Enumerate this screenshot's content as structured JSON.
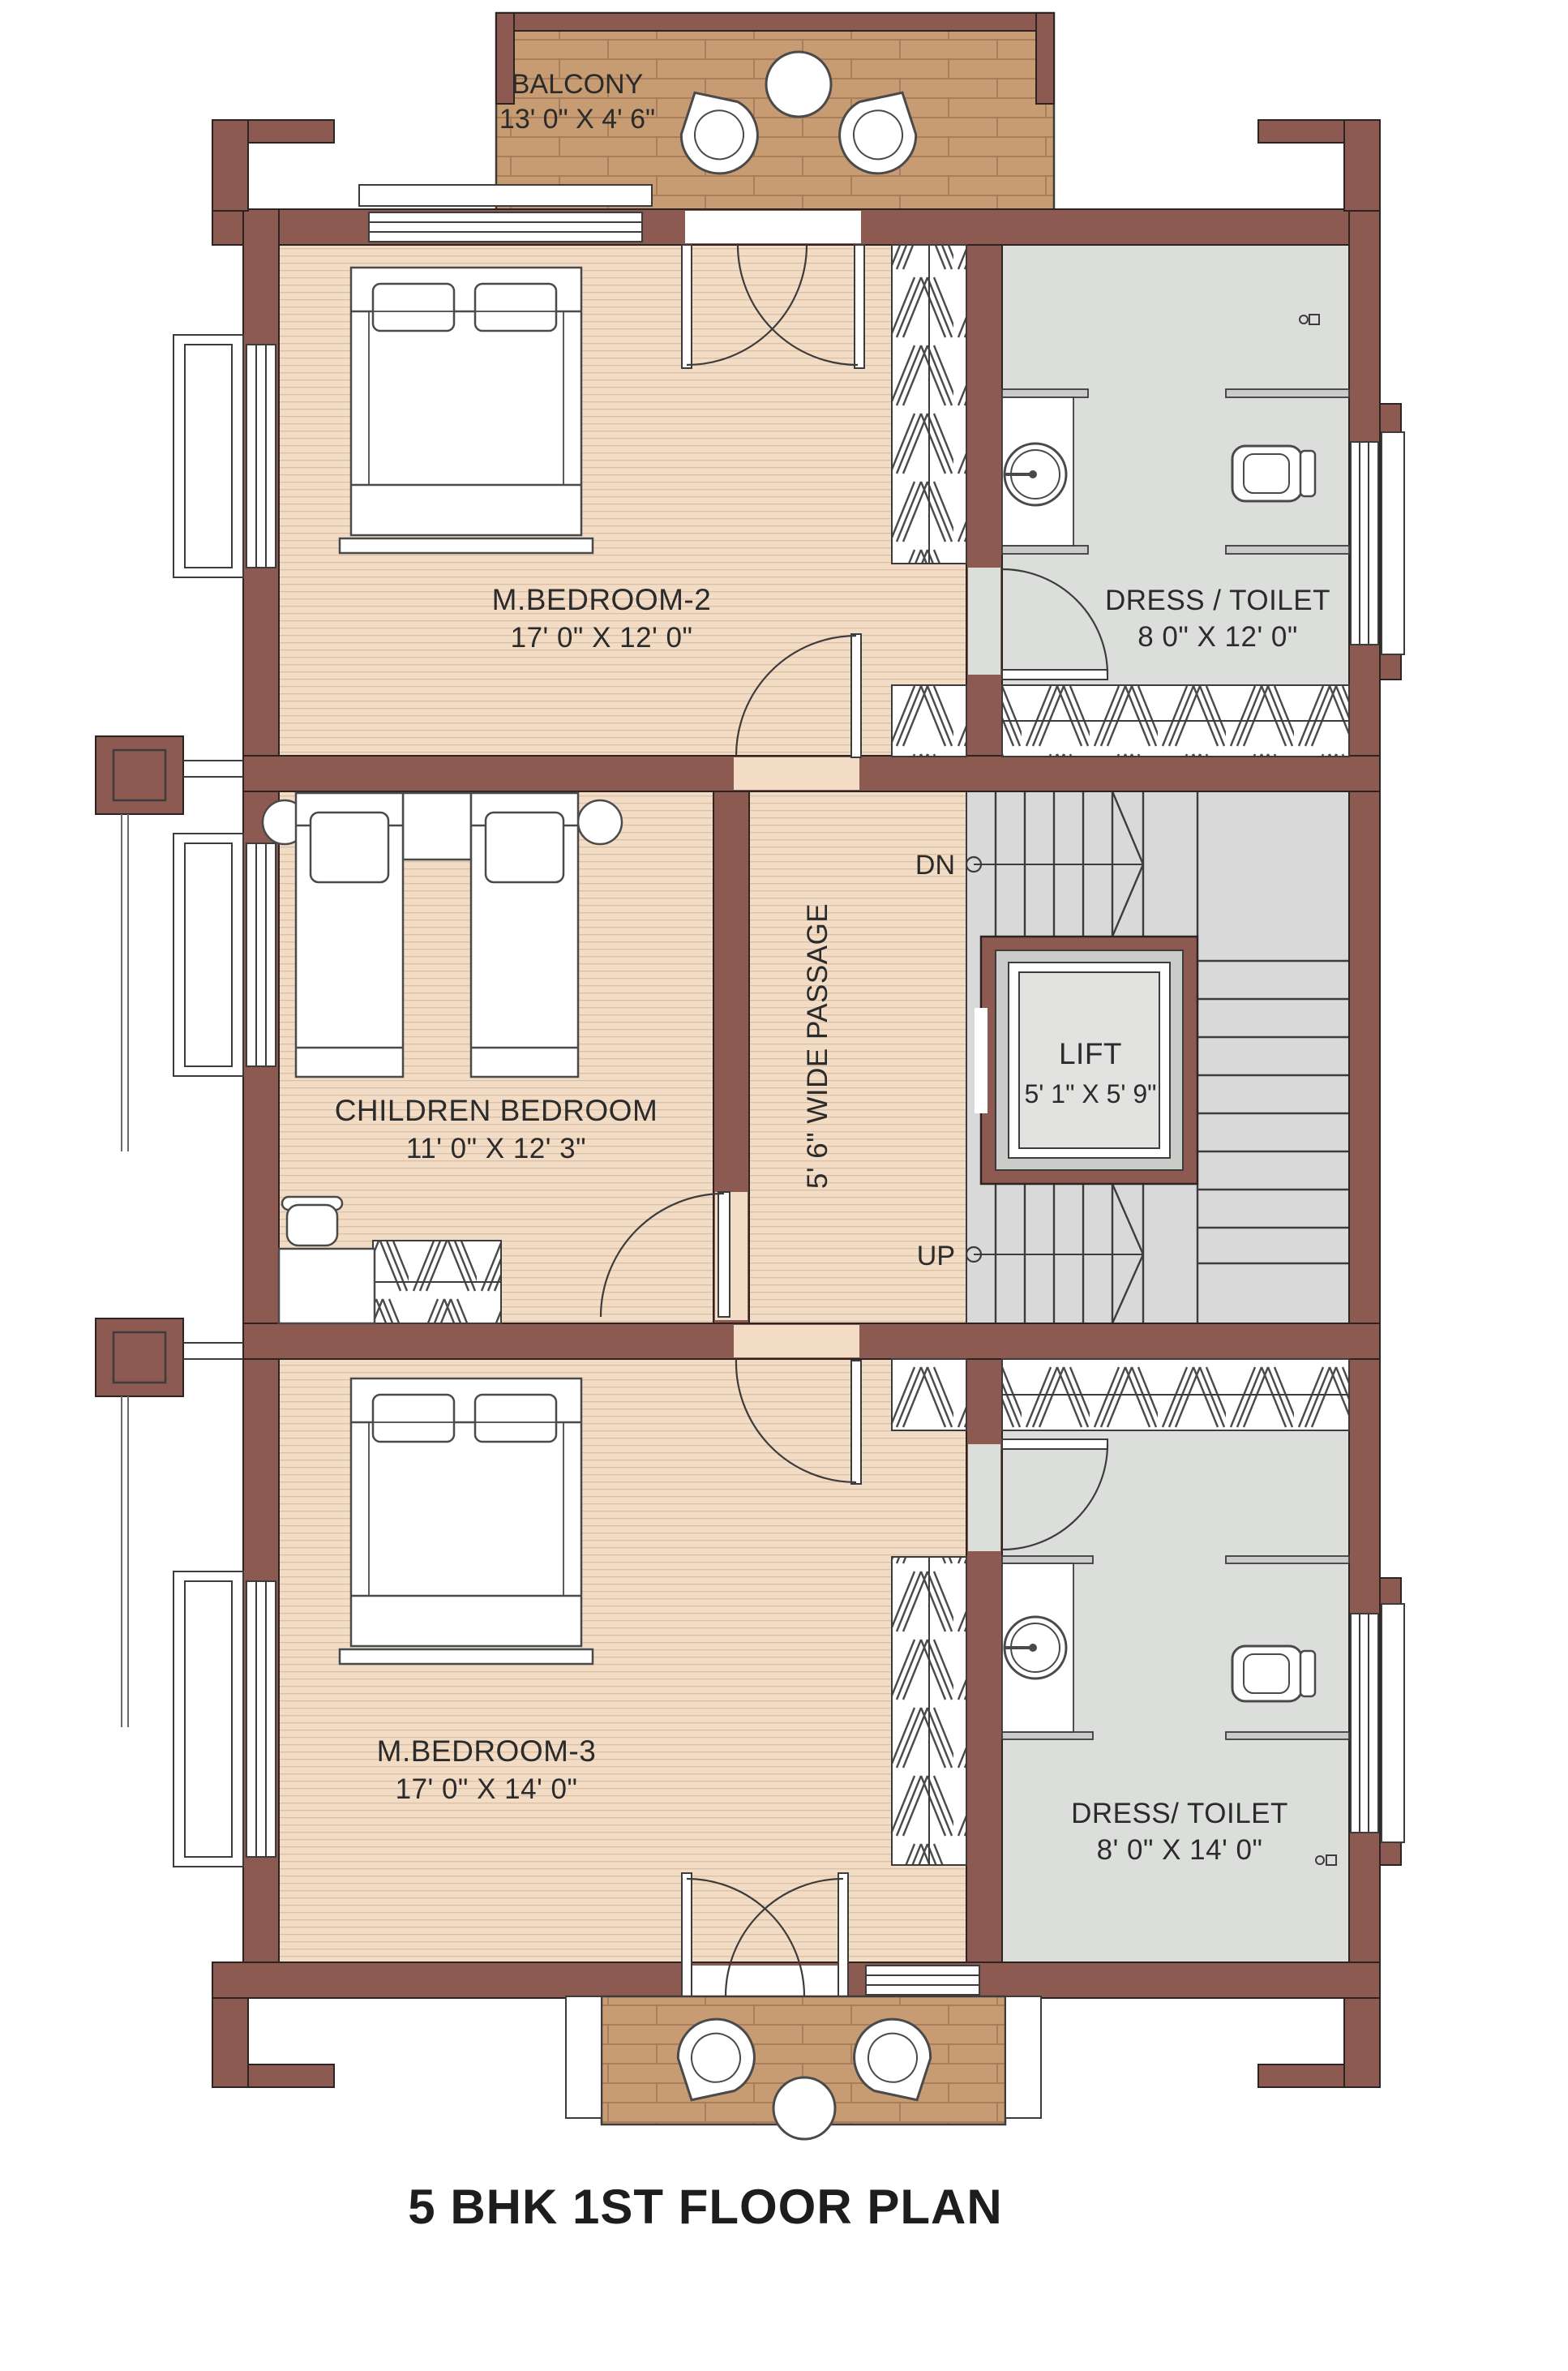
{
  "title": "5 BHK 1ST FLOOR PLAN",
  "colors": {
    "wall": "#8d5a51",
    "bedroom_floor": "#f3dcc6",
    "balcony_floor": "#c89c73",
    "toilet_floor": "#dcdedc",
    "stair_floor": "#d8d9d8",
    "outline": "#3c3c3c"
  },
  "rooms": {
    "balcony_top": {
      "name": "BALCONY",
      "dims": "13' 0\" X 4' 6\""
    },
    "m_bedroom_2": {
      "name": "M.BEDROOM-2",
      "dims": "17' 0\" X 12' 0\""
    },
    "dress_toilet_top": {
      "name": "DRESS / TOILET",
      "dims": "8 0\" X 12' 0\""
    },
    "children_bedroom": {
      "name": "CHILDREN BEDROOM",
      "dims": "11' 0\" X 12' 3\""
    },
    "passage": {
      "name": "5' 6\" WIDE PASSAGE"
    },
    "lift": {
      "name": "LIFT",
      "dims": "5' 1\" X 5' 9\""
    },
    "m_bedroom_3": {
      "name": "M.BEDROOM-3",
      "dims": "17' 0\" X 14' 0\""
    },
    "dress_toilet_bottom": {
      "name": "DRESS/ TOILET",
      "dims": "8' 0\" X 14' 0\""
    }
  },
  "stairs": {
    "down_label": "DN",
    "up_label": "UP"
  }
}
